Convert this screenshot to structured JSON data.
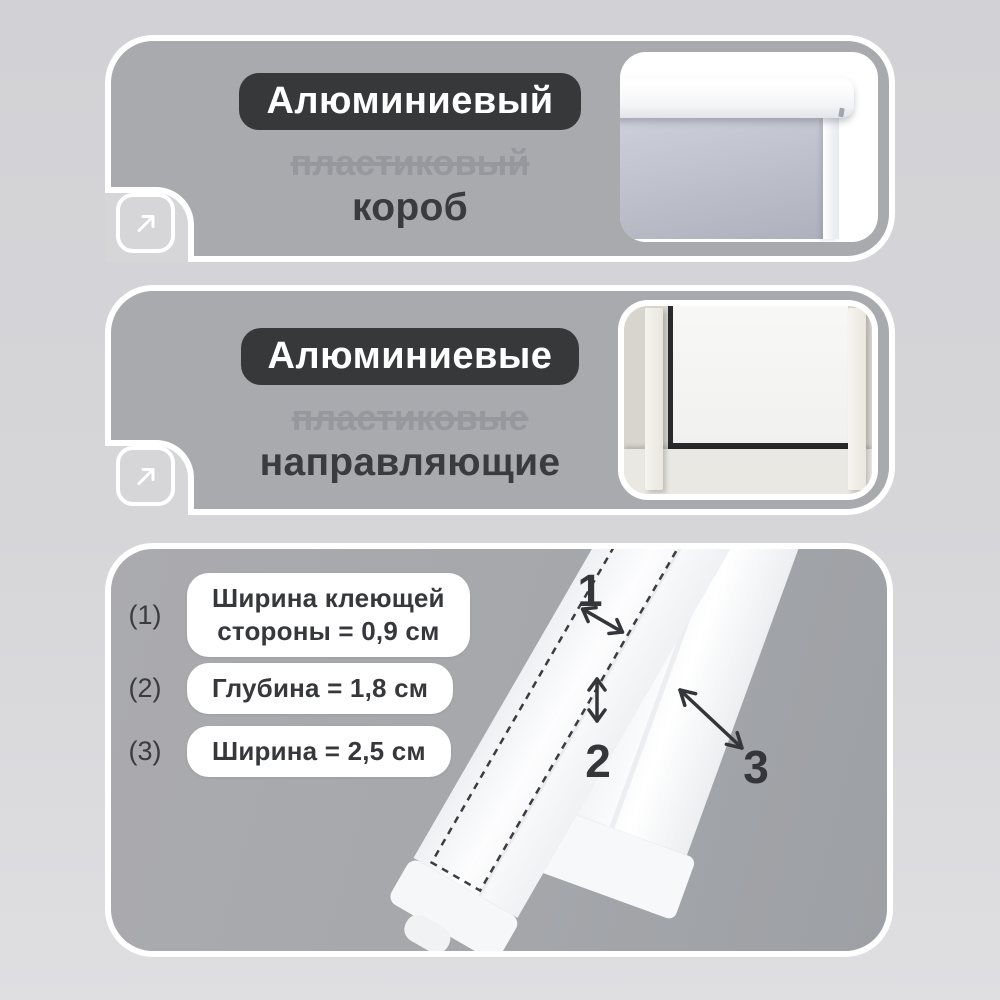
{
  "colors": {
    "page_bg_top": "#d2d2d6",
    "page_bg_bottom": "#dfdfe2",
    "card_fill": "#a8aaae",
    "card_border": "#ffffff",
    "badge_bg": "#37383a",
    "badge_text": "#ffffff",
    "text_dark": "#3a3b3e",
    "text_strikethrough": "#96989d",
    "blind_fabric": "#bcbfca",
    "window_gasket": "#2b2b2e"
  },
  "icons": [
    {
      "name": "expand-arrow-icon",
      "meaning": "diagonal up-right arrow in rounded square"
    }
  ],
  "cards": [
    {
      "badge": "Алюминиевый",
      "strikethrough": "пластиковый",
      "title": "короб"
    },
    {
      "badge": "Алюминиевые",
      "strikethrough": "пластиковые",
      "title": "направляющие"
    }
  ],
  "specs": {
    "rows": [
      {
        "num": "(1)",
        "lines": [
          "Ширина клеющей",
          "стороны = 0,9 см"
        ]
      },
      {
        "num": "(2)",
        "lines": [
          "Глубина = 1,8 см"
        ]
      },
      {
        "num": "(3)",
        "lines": [
          "Ширина = 2,5 см"
        ]
      }
    ],
    "markers": [
      "1",
      "2",
      "3"
    ]
  }
}
